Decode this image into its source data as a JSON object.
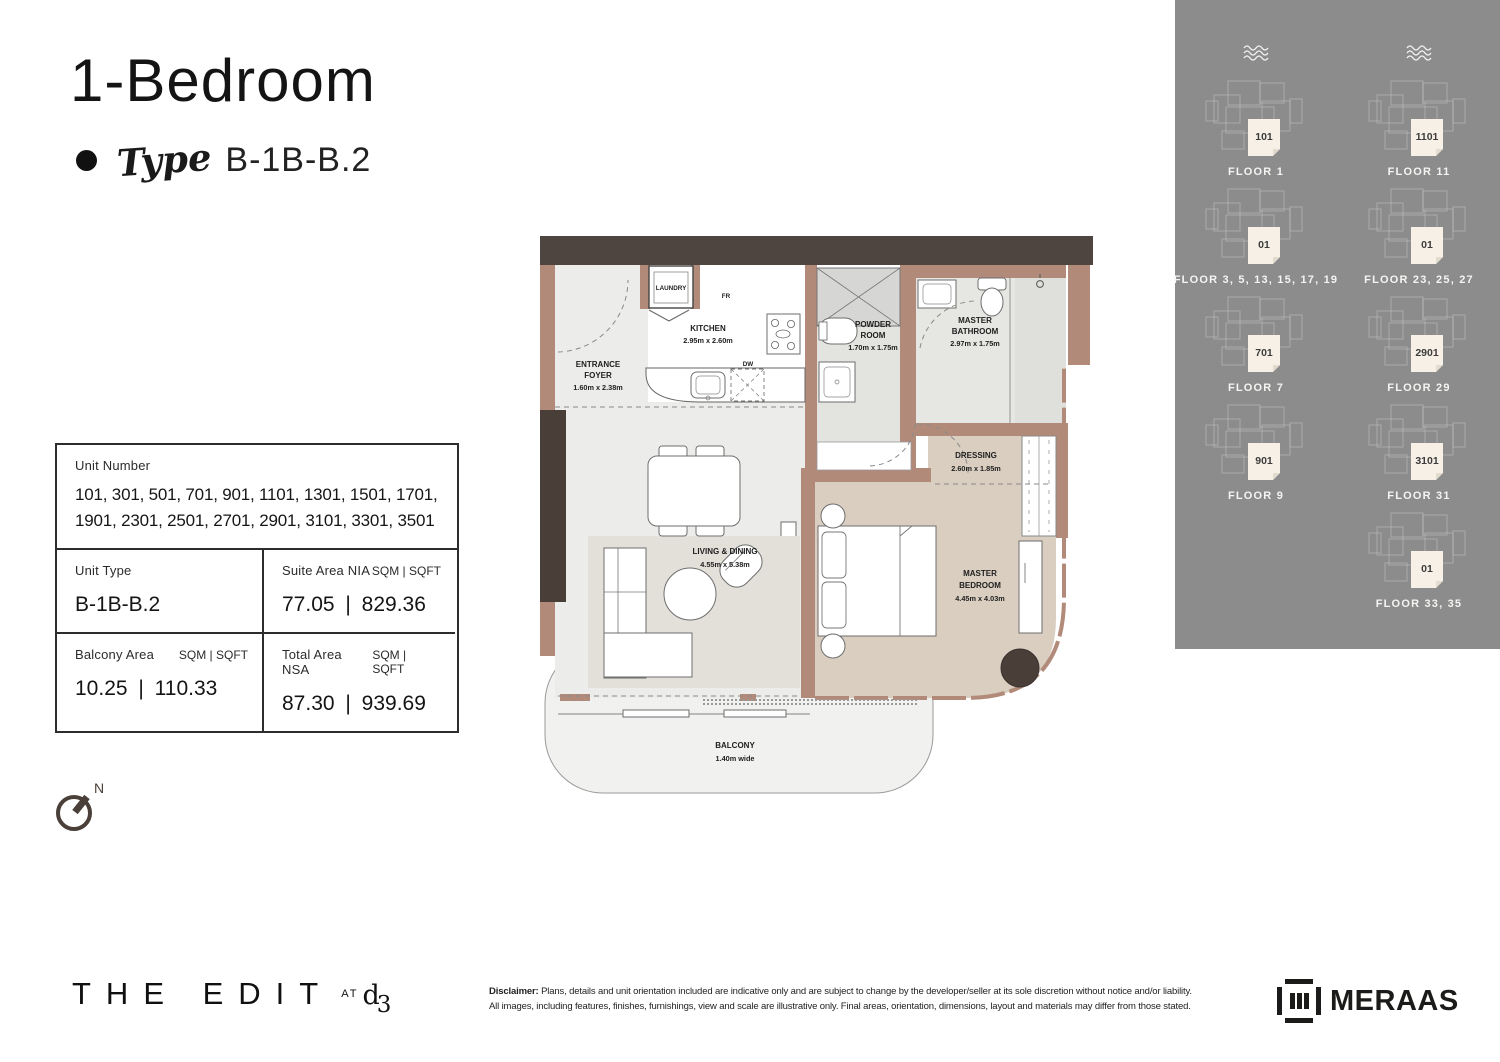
{
  "header": {
    "title": "1-Bedroom",
    "type_label": "Type",
    "type_value": "B-1B-B.2"
  },
  "info": {
    "unit_number_label": "Unit Number",
    "unit_numbers_line1": "101, 301, 501, 701, 901, 1101, 1301,  1501, 1701,",
    "unit_numbers_line2": "1901, 2301, 2501, 2701, 2901, 3101, 3301, 3501",
    "unit_type_label": "Unit Type",
    "unit_type_value": "B-1B-B.2",
    "units_header": "SQM | SQFT",
    "suite_label": "Suite Area NIA",
    "suite_value": "77.05 | 829.36",
    "balcony_label": "Balcony Area",
    "balcony_value": "10.25 | 110.33",
    "total_label": "Total Area NSA",
    "total_value": "87.30 | 939.69"
  },
  "floor_plan": {
    "compass": "N",
    "rooms": {
      "foyer": {
        "l1": "ENTRANCE",
        "l2": "FOYER",
        "dims": "1.60m x 2.38m"
      },
      "laundry": {
        "l1": "LAUNDRY"
      },
      "kitchen": {
        "l1": "KITCHEN",
        "dims": "2.95m x 2.60m"
      },
      "powder": {
        "l1": "POWDER",
        "l2": "ROOM",
        "dims": "1.70m x 1.75m"
      },
      "bath": {
        "l1": "MASTER",
        "l2": "BATHROOM",
        "dims": "2.97m x 1.75m"
      },
      "dressing": {
        "l1": "DRESSING",
        "dims": "2.60m x 1.85m"
      },
      "living": {
        "l1": "LIVING & DINING",
        "dims": "4.55m x 5.38m"
      },
      "bedroom": {
        "l1": "MASTER",
        "l2": "BEDROOM",
        "dims": "4.45m x 4.03m"
      },
      "balcony": {
        "l1": "BALCONY",
        "dims": "1.40m wide"
      }
    },
    "appliances": {
      "fr": "FR",
      "dw": "DW"
    }
  },
  "floor_key": {
    "items": [
      {
        "unit": "101",
        "floor": "FLOOR 1"
      },
      {
        "unit": "1101",
        "floor": "FLOOR 11"
      },
      {
        "unit": "01",
        "floor": "FLOOR 3, 5, 13, 15, 17, 19"
      },
      {
        "unit": "01",
        "floor": "FLOOR 23, 25, 27"
      },
      {
        "unit": "701",
        "floor": "FLOOR 7"
      },
      {
        "unit": "2901",
        "floor": "FLOOR 29"
      },
      {
        "unit": "901",
        "floor": "FLOOR 9"
      },
      {
        "unit": "3101",
        "floor": "FLOOR 31"
      },
      {
        "unit": "01",
        "floor": "FLOOR 33, 35"
      }
    ]
  },
  "footer": {
    "brand": "THE EDIT",
    "brand_at": "AT",
    "brand_d3": "d3",
    "disclaimer_label": "Disclaimer:",
    "disclaimer_line1": "Plans, details and unit orientation included are indicative only and are subject to change by the developer/seller at its sole discretion without notice and/or liability.",
    "disclaimer_line2": "All images, including features, finishes, furnishings, view and scale are illustrative only. Final areas, orientation, dimensions, layout and materials may differ from those stated.",
    "developer": "MERAAS"
  },
  "colors": {
    "wall": "#b28a79",
    "dark_trim": "#4a3f39",
    "sidebar_bg": "#8c8c8c",
    "unit_highlight": "#f6f0e6",
    "bedroom_floor": "#d9cec0",
    "living_floor": "#ececea",
    "balcony_floor": "#f1f1ef"
  }
}
